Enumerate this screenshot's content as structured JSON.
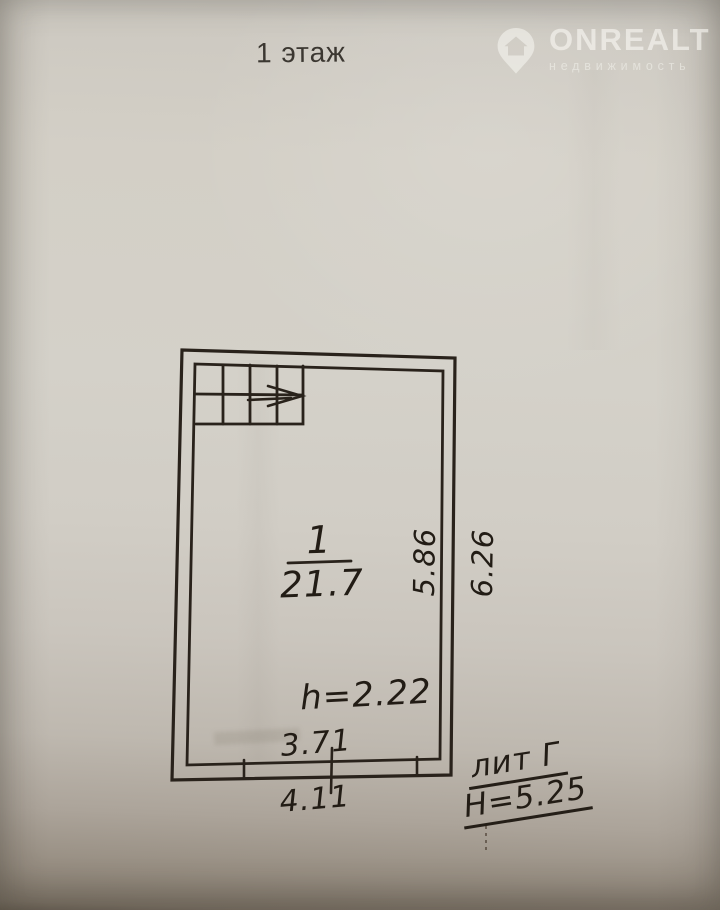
{
  "page": {
    "title": "1 этаж"
  },
  "logo": {
    "brand": "ONREALT",
    "subtitle": "недвижимость",
    "icon": "map-pin-house-icon",
    "color": "#f8f7f2"
  },
  "plan": {
    "room_number": "1",
    "room_area": "21.7",
    "ceiling_height": "h=2.22",
    "dim_inner_width": "3.71",
    "dim_outer_width": "4.11",
    "dim_inner_depth": "5.86",
    "dim_outer_depth": "6.26",
    "liter_label": "лит Г",
    "building_height": "Н=5.25"
  },
  "colors": {
    "ink": "#29221b",
    "paper": "#d3cfc6"
  }
}
